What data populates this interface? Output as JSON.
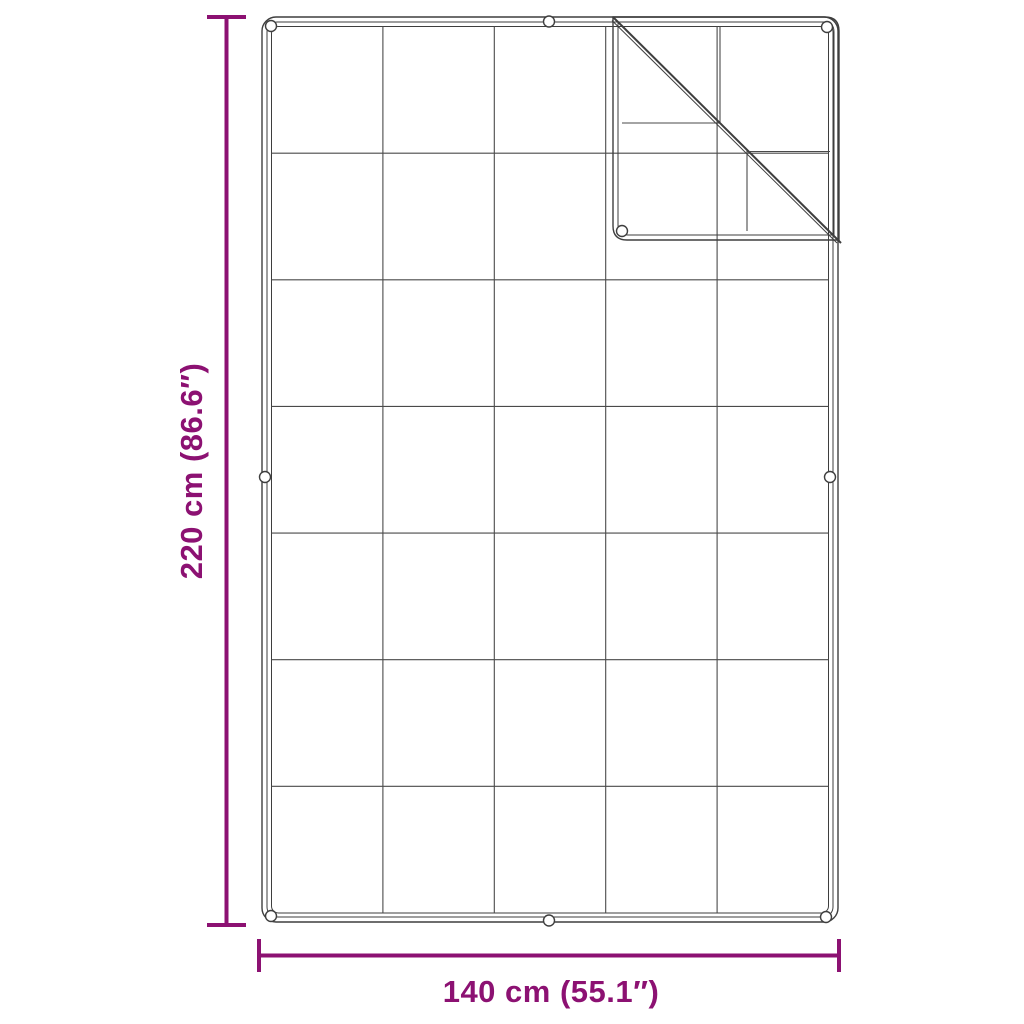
{
  "diagram": {
    "height_label": "220 cm (86.6″)",
    "width_label": "140 cm (55.1″)",
    "grid": {
      "columns": 5,
      "rows": 7
    },
    "grommet_count": 9
  },
  "colors": {
    "accent": "#8C1172",
    "outline": "#3E3E3E",
    "grid_line": "#4A4A4A",
    "background": "#FFFFFF"
  }
}
